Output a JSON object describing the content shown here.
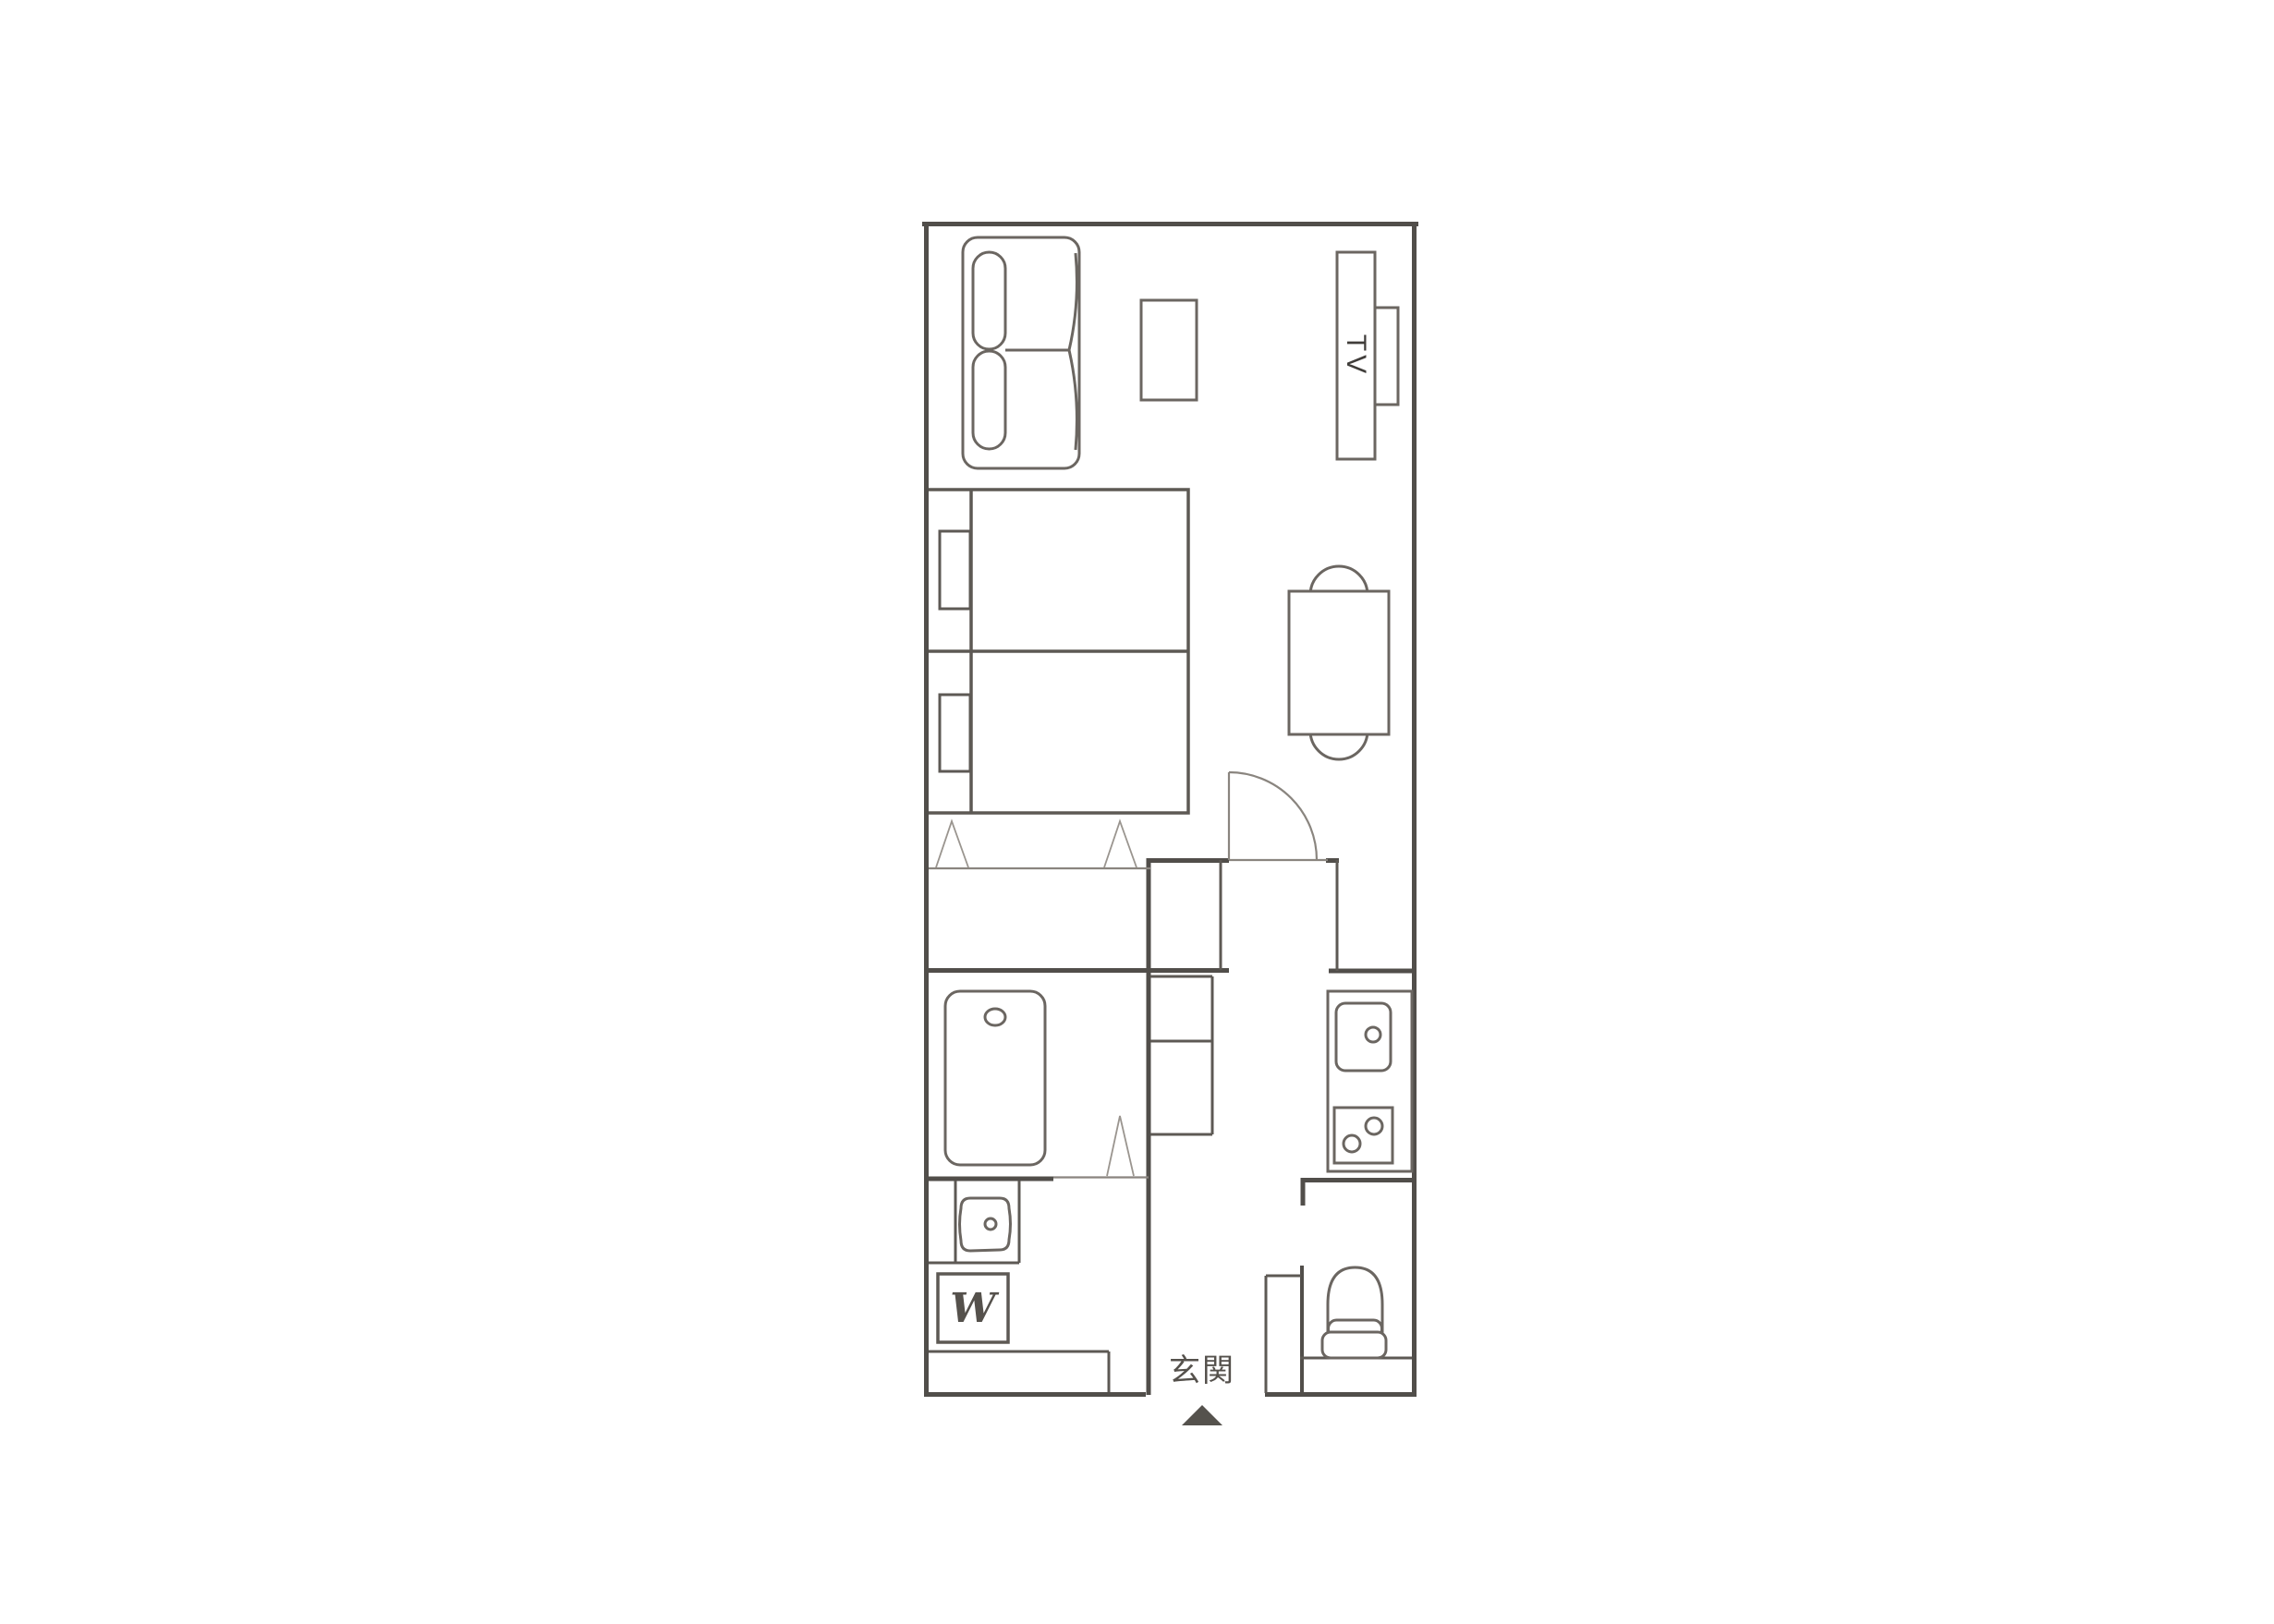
{
  "plan": {
    "labels": {
      "tv": "TV",
      "washing_machine": "W",
      "entrance": "玄関"
    },
    "colors": {
      "background": "#ffffff",
      "wall": "#514e4a",
      "medium_line": "#5d5954",
      "furniture_line": "#6b6661",
      "symbol_line": "#9a958f",
      "label_text": "#55514c",
      "arrow": "#55524d"
    }
  }
}
